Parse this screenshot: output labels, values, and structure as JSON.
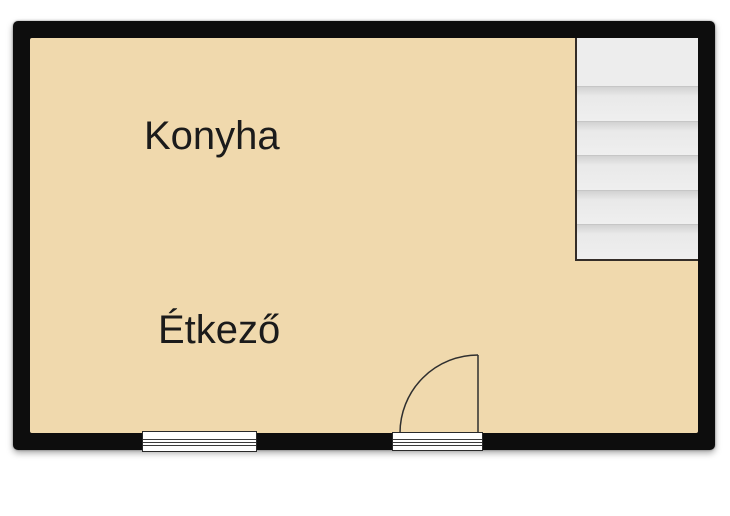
{
  "floorplan": {
    "rooms": [
      {
        "name": "Konyha"
      },
      {
        "name": "Étkező"
      }
    ],
    "staircase": {
      "steps": 6,
      "position": "top-right"
    },
    "symbols": [
      {
        "name": "window",
        "wall": "bottom"
      },
      {
        "name": "door-swing",
        "wall": "bottom",
        "swing": "inward-left"
      }
    ],
    "colors": {
      "wall": "#0d0d0d",
      "floor": "#f0d9ad",
      "staircase_fill": "#ededed",
      "staircase_border": "#342d28",
      "symbol_line": "#2f2f2f",
      "label_text": "#1b1b1b",
      "background": "#ffffff"
    }
  }
}
